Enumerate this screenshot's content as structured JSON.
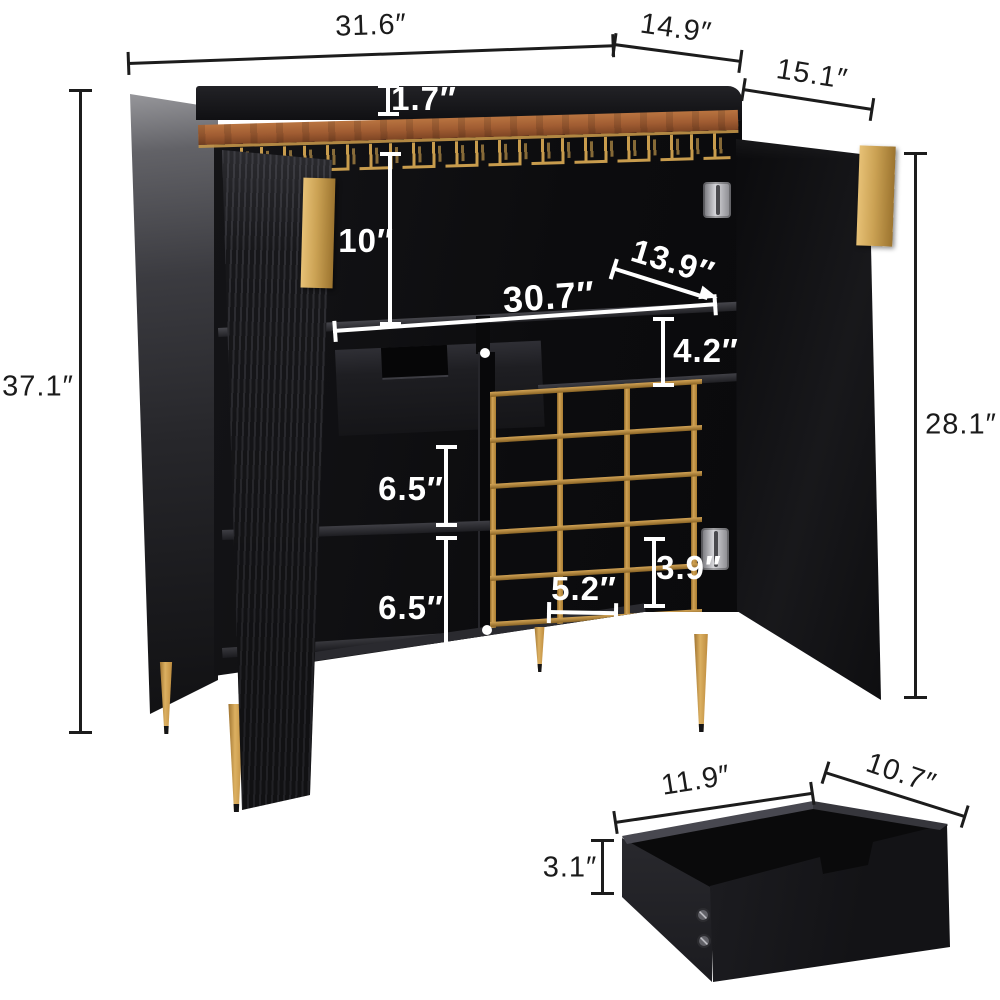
{
  "diagram": {
    "title": "wine bar cabinet dimension diagram",
    "units": "inches"
  },
  "labels": {
    "top_width": "31.6″",
    "top_depth": "14.9″",
    "side_depth": "15.1″",
    "overall_height": "37.1″",
    "door_height": "28.1″",
    "backsplash_height": "1.7″",
    "top_compartment_height": "10″",
    "interior_depth": "13.9″",
    "interior_width": "30.7″",
    "right_gap_height": "4.2″",
    "upper_shelf_height": "6.5″",
    "lower_shelf_height": "6.5″",
    "wine_cube_width": "5.2″",
    "wine_cube_height": "3.9″",
    "drawer_width": "11.9″",
    "drawer_depth": "10.7″",
    "drawer_height": "3.1″"
  },
  "colors": {
    "background": "#ffffff",
    "cabinet_black": "#121214",
    "gold_accent": "#c89c4d",
    "wood_top": "#a05c32",
    "dimension_line_dark": "#1c1c1c",
    "dimension_line_light": "#ffffff"
  }
}
